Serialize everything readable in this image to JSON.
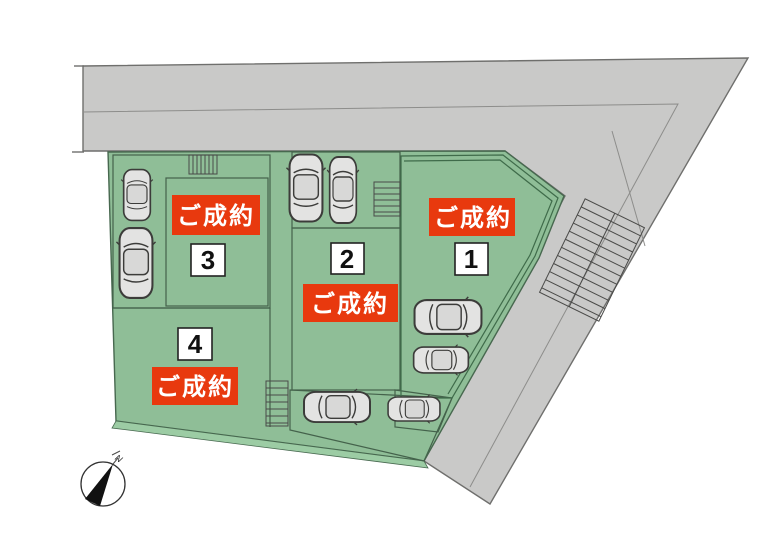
{
  "lots": [
    {
      "number": "1",
      "status": "ご成約",
      "fill": "#b9edc4"
    },
    {
      "number": "2",
      "status": "ご成約",
      "fill": "#7fa487"
    },
    {
      "number": "3",
      "status": "ご成約",
      "fill": "#7d9e85"
    },
    {
      "number": "4",
      "status": "ご成約",
      "fill": "#8fbe97"
    }
  ],
  "compass": {
    "north_label": "N"
  },
  "colors": {
    "status_bg": "#e8390e",
    "status_text": "#ffffff",
    "road": "#c9c9c8",
    "site": "#8fbe97",
    "lot2_parking": "#8cb894",
    "south_parking": "#7cc185",
    "slope_strip": "#6fa078",
    "curb_strip": "#9ccca4",
    "number_box_bg": "#ffffff"
  }
}
